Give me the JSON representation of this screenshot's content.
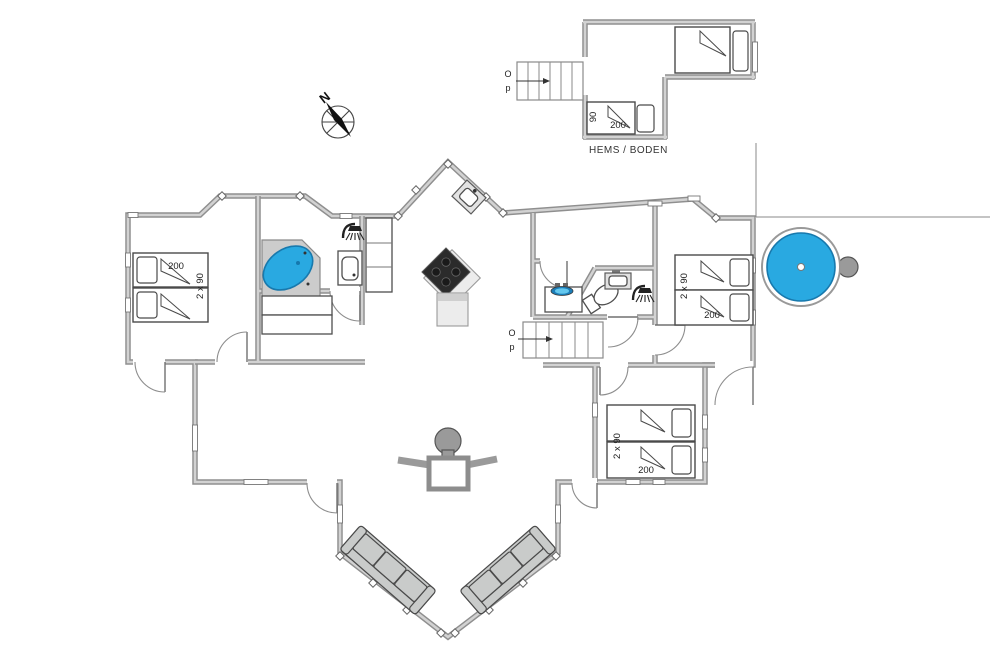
{
  "colors": {
    "water_fill": "#29a9e1",
    "water_stroke": "#1879ad",
    "water_deep": "#1b7db8",
    "wall": "#8f8f8f",
    "wall_core": "#d2d2d2",
    "furniture_fill": "#c9cbca",
    "dark_appliance": "#2b2b2b"
  },
  "compass": {
    "north_label": "N"
  },
  "outbuilding": {
    "name_label": "HEMS / BODEN",
    "stairs": {
      "up": "O",
      "down": "p"
    },
    "bed": {
      "width": "90",
      "length": "200"
    }
  },
  "main": {
    "stairs": {
      "up": "O",
      "down": "p"
    },
    "bedroom_left": {
      "length": "200",
      "width": "2 x 90"
    },
    "bedroom_right_upper": {
      "length": "200",
      "width": "2 x 90"
    },
    "bedroom_right_lower": {
      "length": "200",
      "width": "2 x 90"
    }
  }
}
